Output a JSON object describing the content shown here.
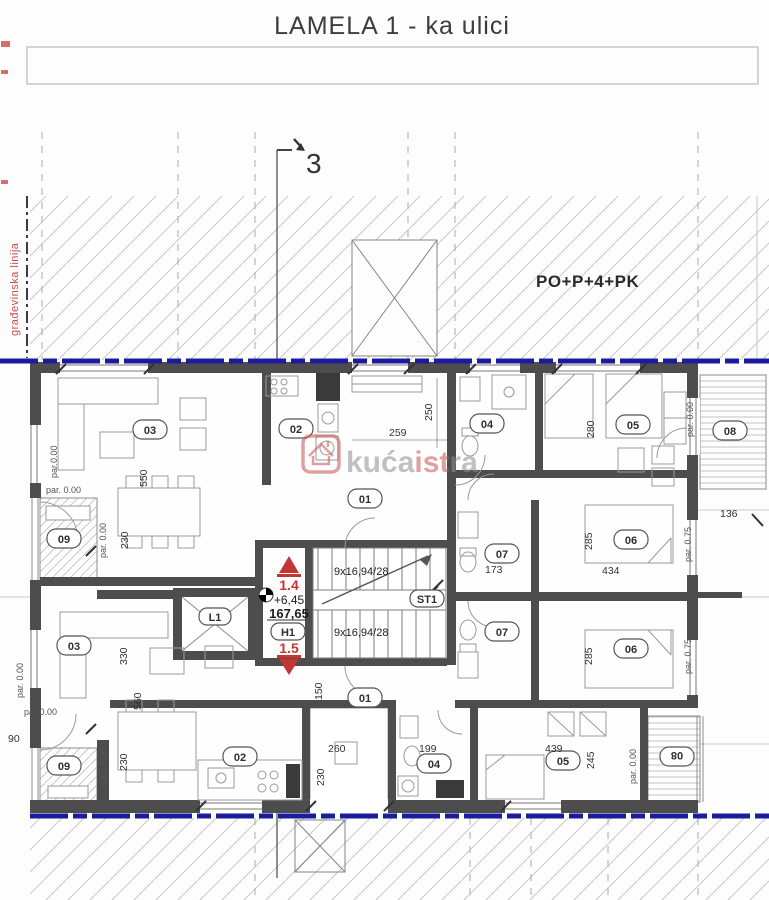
{
  "title": "LAMELA 1 - ka ulici",
  "annotations": {
    "building_line": "građevinska linija",
    "floors": "PO+P+4+PK",
    "section_number": "3"
  },
  "core": {
    "level_up": "1.4",
    "elevation": "+6,45",
    "area": "167,65",
    "unit": "H1",
    "level_down": "1.5",
    "stair_run_top": "9x16,94/28",
    "stair_run_bottom": "9x16,94/28",
    "stair_label": "ST1",
    "lift_label": "L1"
  },
  "rooms": {
    "living_top": "03",
    "kitchen_top": "02",
    "balcony_left_top": "09",
    "hall_top": "01",
    "bath_top": "04",
    "bedroom_top": "05",
    "balcony_right_top": "08",
    "bath_mid_upper": "07",
    "bedroom_mid_upper": "06",
    "bath_mid_lower": "07",
    "bedroom_mid_lower": "06",
    "living_bottom": "03",
    "balcony_left_bottom": "09",
    "kitchen_bottom": "02",
    "hall_bottom": "01",
    "bath_bottom": "04",
    "bedroom_bottom": "05",
    "balcony_right_bottom": "08"
  },
  "dims": {
    "d550": "550",
    "d230a": "230",
    "d259": "259",
    "d250": "250",
    "d280": "280",
    "d285a": "285",
    "d434": "434",
    "d173": "173",
    "d136": "136",
    "d285b": "285",
    "d330": "330",
    "d560": "560",
    "d230b": "230",
    "d90": "90",
    "d150": "150",
    "d260": "260",
    "d230c": "230",
    "d199": "199",
    "d439": "439",
    "d245": "245"
  },
  "pars": {
    "p1": "par.0.00",
    "p2": "par. 0.00",
    "p3": "par. 0.00",
    "p4": "par. 0.00",
    "p5": "par 0.00",
    "p6": "par. 0.00",
    "p7": "par. 0.00",
    "p8": "par. 0.75",
    "p9": "par. 0.75",
    "p10": "par. 0.00"
  },
  "watermark": {
    "gray1": "kuća",
    "red": "ist",
    "gray2": "ra"
  },
  "colors": {
    "wall": "#4d4d4d",
    "blue_line": "#1b1b9e",
    "red_accent": "#c43535",
    "hatch": "#c9c9c9",
    "thin": "#8c8c8c"
  }
}
